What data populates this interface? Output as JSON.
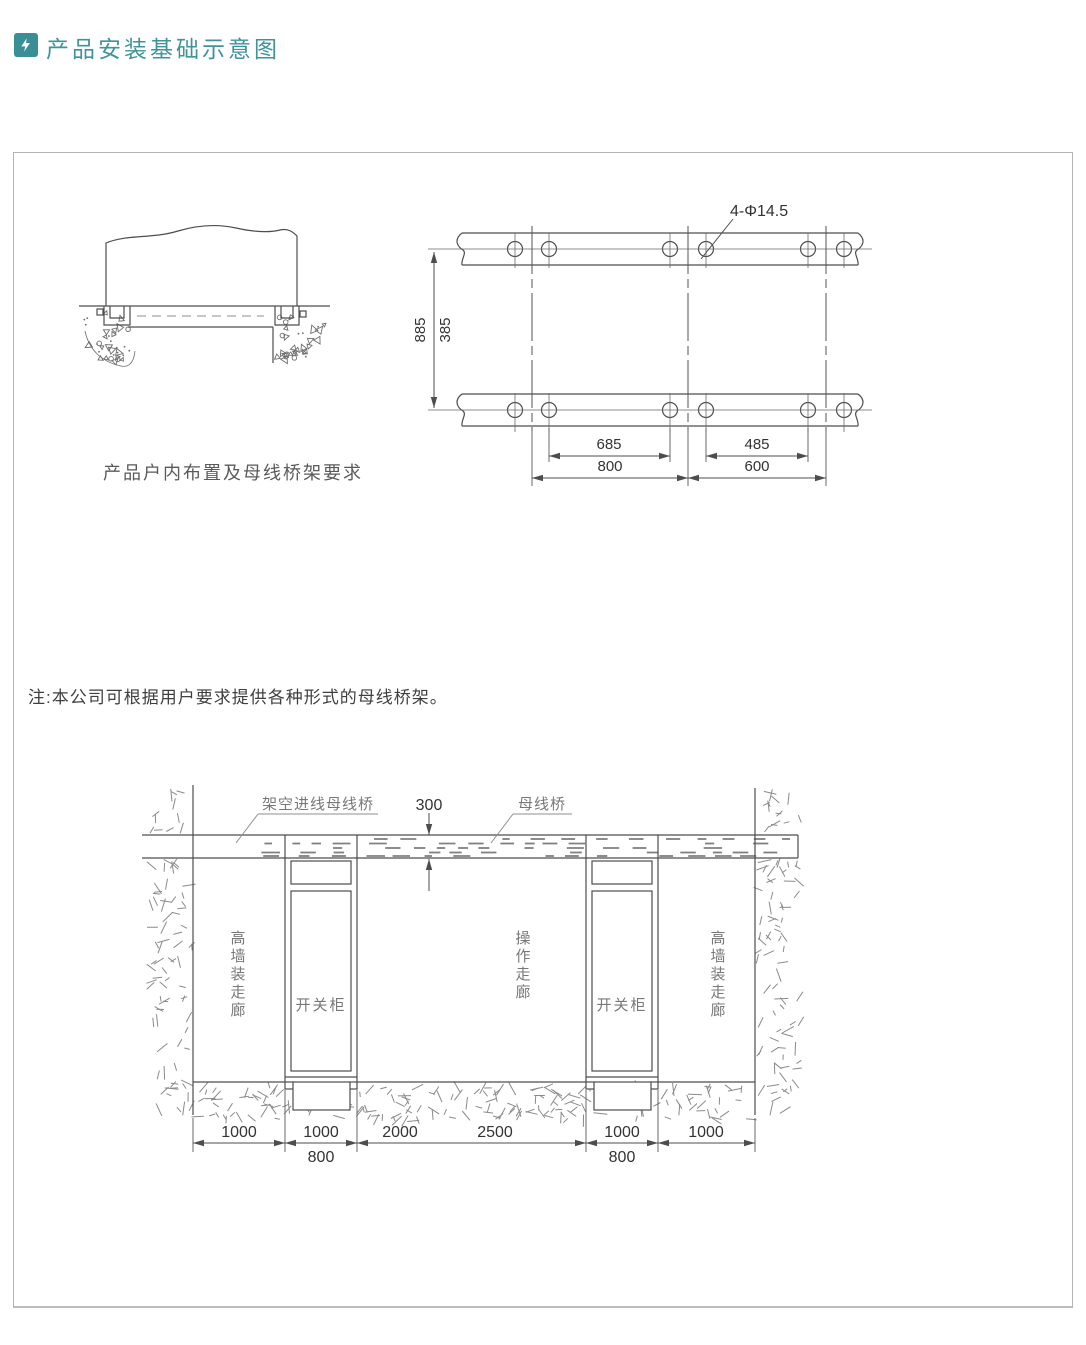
{
  "header": {
    "title": "产品安装基础示意图"
  },
  "panel": {
    "plan_view": {
      "hole_label": "4-Φ14.5",
      "dim_depth_a": "885",
      "dim_depth_b": "385",
      "dim_hole_span_left": "685",
      "dim_panel_left": "800",
      "dim_hole_span_right": "485",
      "dim_panel_right": "600",
      "caption": "产品户内布置及母线桥架要求"
    },
    "note": "注:本公司可根据用户要求提供各种形式的母线桥架。",
    "section_view": {
      "label_overhead_busbar": "架空进线母线桥",
      "label_busbar_bridge": "母线桥",
      "dim_bridge_height": "300",
      "label_corridor_left": "高墙装走廊",
      "label_corridor_center": "操作走廊",
      "label_corridor_right": "高墙装走廊",
      "label_cabinet_left": "开关柜",
      "label_cabinet_right": "开关柜",
      "dim_corridor_left": "1000",
      "dim_cabinet_left_a": "1000",
      "dim_cabinet_left_b": "800",
      "dim_center_a": "2000",
      "dim_center_b": "2500",
      "dim_cabinet_right_a": "1000",
      "dim_cabinet_right_b": "800",
      "dim_corridor_right": "1000"
    }
  },
  "colors": {
    "accent": "#3f939b",
    "line": "#4d4d4d"
  }
}
